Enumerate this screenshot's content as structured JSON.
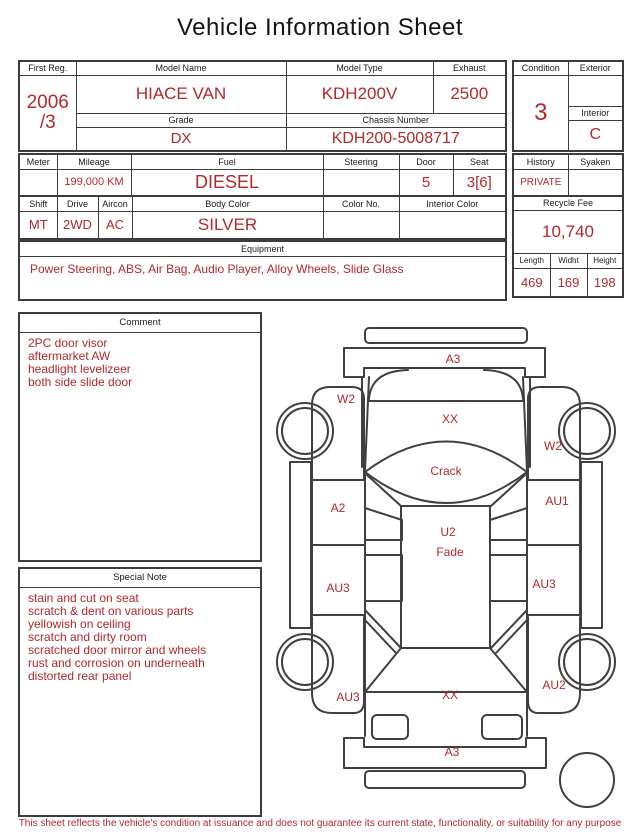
{
  "title": "Vehicle Information Sheet",
  "fields": {
    "first_reg": {
      "label": "First Reg.",
      "line1": "2006",
      "line2": "/3"
    },
    "model_name": {
      "label": "Model Name",
      "value": "HIACE VAN"
    },
    "model_type": {
      "label": "Model Type",
      "value": "KDH200V"
    },
    "exhaust": {
      "label": "Exhaust",
      "value": "2500"
    },
    "grade": {
      "label": "Grade",
      "value": "DX"
    },
    "chassis_number": {
      "label": "Chassis Number",
      "value": "KDH200-5008717"
    },
    "condition": {
      "label": "Condition",
      "value": "3"
    },
    "exterior": {
      "label": "Exterior",
      "value": ""
    },
    "interior": {
      "label": "Interior",
      "value": "C"
    },
    "meter": {
      "label": "Meter",
      "value": ""
    },
    "mileage": {
      "label": "Mileage",
      "value": "199,000 KM"
    },
    "fuel": {
      "label": "Fuel",
      "value": "DIESEL"
    },
    "steering": {
      "label": "Steering",
      "value": ""
    },
    "door": {
      "label": "Door",
      "value": "5"
    },
    "seat": {
      "label": "Seat",
      "value": "3[6]"
    },
    "history": {
      "label": "History",
      "value": "PRIVATE"
    },
    "syaken": {
      "label": "Syaken",
      "value": ""
    },
    "shift": {
      "label": "Shift",
      "value": "MT"
    },
    "drive": {
      "label": "Drive",
      "value": "2WD"
    },
    "aircon": {
      "label": "Aircon",
      "value": "AC"
    },
    "body_color": {
      "label": "Body Color",
      "value": "SILVER"
    },
    "color_no": {
      "label": "Color No.",
      "value": ""
    },
    "interior_color": {
      "label": "Interior Color",
      "value": ""
    },
    "recycle_fee": {
      "label": "Recycle Fee",
      "value": "10,740"
    },
    "equipment": {
      "label": "Equipment",
      "value": "Power Steering, ABS, Air Bag, Audio Player, Alloy Wheels, Slide Glass"
    },
    "length": {
      "label": "Length",
      "value": "469"
    },
    "width": {
      "label": "Widht",
      "value": "169"
    },
    "height": {
      "label": "Height",
      "value": "198"
    }
  },
  "comment": {
    "label": "Comment",
    "lines": [
      "2PC door visor",
      "aftermarket AW",
      "headlight levelizeer",
      "both side slide door"
    ]
  },
  "special_note": {
    "label": "Special Note",
    "lines": [
      "stain and cut on seat",
      "scratch & dent on various parts",
      "yellowish on ceiling",
      "scratch and dirty room",
      "scratched door mirror and wheels",
      "rust and corrosion on underneath",
      "distorted rear panel"
    ]
  },
  "diagram": {
    "marks": [
      {
        "id": "front-bumper",
        "text": "A3"
      },
      {
        "id": "left-front-fender",
        "text": "W2"
      },
      {
        "id": "front-panel",
        "text": "XX"
      },
      {
        "id": "windshield",
        "text": "Crack"
      },
      {
        "id": "right-front-fender",
        "text": "W2"
      },
      {
        "id": "left-front-door",
        "text": "A2"
      },
      {
        "id": "right-front-door",
        "text": "AU1"
      },
      {
        "id": "roof",
        "text": "U2"
      },
      {
        "id": "roof-condition",
        "text": "Fade"
      },
      {
        "id": "left-slide-door",
        "text": "AU3"
      },
      {
        "id": "right-slide-door",
        "text": "AU3"
      },
      {
        "id": "left-rear-fender",
        "text": "AU3"
      },
      {
        "id": "rear-panel",
        "text": "XX"
      },
      {
        "id": "right-rear-fender",
        "text": "AU2"
      },
      {
        "id": "rear-bumper",
        "text": "A3"
      }
    ]
  },
  "footer": "This sheet reflects the vehicle's condition at issuance and does not guarantee its current state, functionality, or suitability for any purpose",
  "colors": {
    "accent_red": "#b5282c",
    "border": "#3c3c3c",
    "text": "#1b1b1b"
  }
}
